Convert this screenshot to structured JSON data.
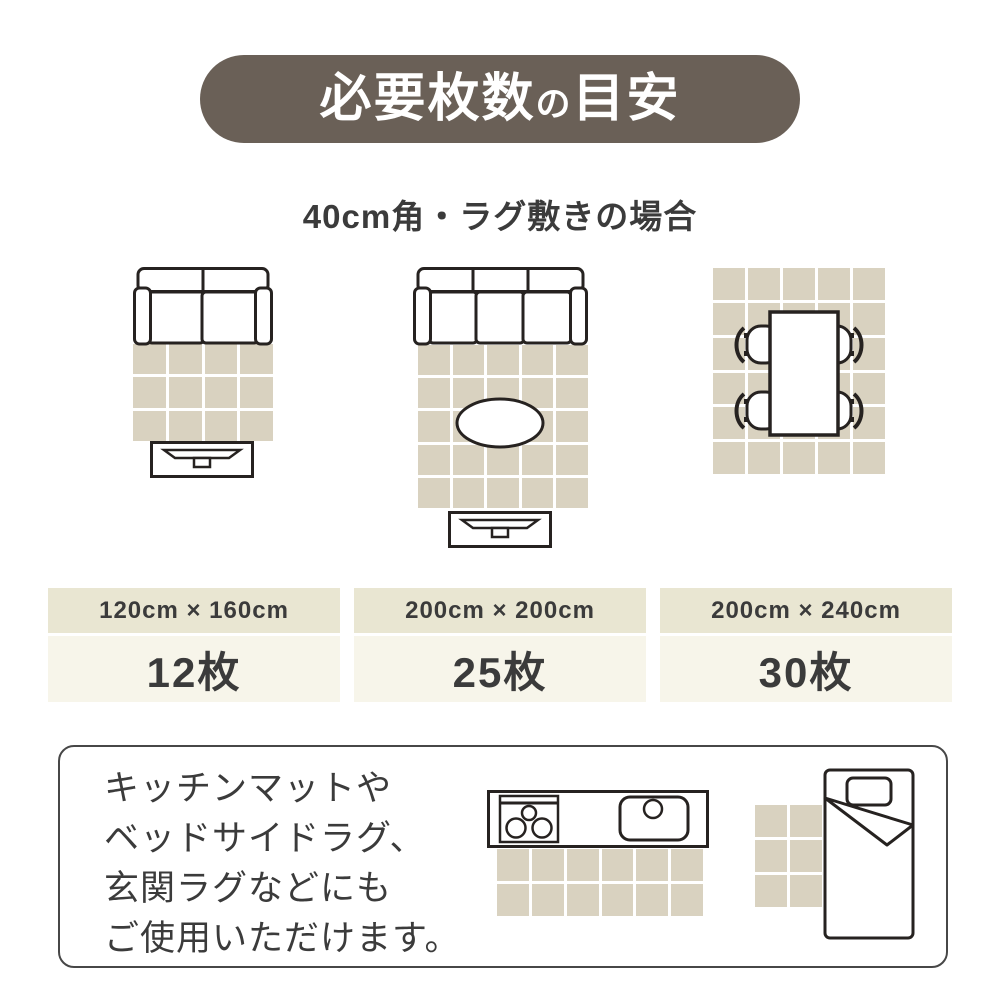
{
  "title": {
    "part1": "必要枚数",
    "particle": "の",
    "part2": "目安"
  },
  "subtitle": "40cm角・ラグ敷きの場合",
  "colors": {
    "banner_bg": "#6a6057",
    "rug_tile": "#d9d2c0",
    "table_header_bg": "#e9e6d2",
    "table_value_bg": "#f7f5ea",
    "outline_ink": "#262220",
    "text_dark": "#3b3b3b"
  },
  "layouts": [
    {
      "name": "sofa-small-living",
      "size": "120cm × 160cm",
      "count": "12枚",
      "grid": {
        "cols": 4,
        "rows": 3
      },
      "furniture": [
        "sofa-2seat",
        "tv-board"
      ]
    },
    {
      "name": "sofa-large-living",
      "size": "200cm × 200cm",
      "count": "25枚",
      "grid": {
        "cols": 5,
        "rows": 5
      },
      "furniture": [
        "sofa-3seat",
        "coffee-table",
        "tv-board"
      ]
    },
    {
      "name": "dining-room",
      "size": "200cm × 240cm",
      "count": "30枚",
      "grid": {
        "cols": 5,
        "rows": 6
      },
      "furniture": [
        "dining-table",
        "four-chairs"
      ]
    }
  ],
  "note": {
    "lines": [
      "キッチンマットや",
      "ベッドサイドラグ、",
      "玄関ラグなどにも",
      "ご使用いただけます。"
    ]
  },
  "extra_rugs": {
    "kitchen_mat": {
      "cols": 6,
      "rows": 2
    },
    "bedside_rug": {
      "cols": 2,
      "rows": 3
    }
  }
}
